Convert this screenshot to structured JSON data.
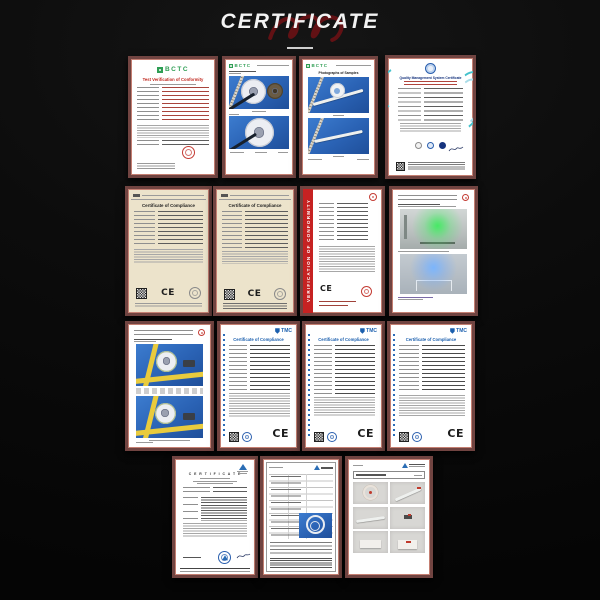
{
  "page": {
    "title": "CERTIFICATE",
    "section": "product certificates gallery",
    "background_color": "#0c0c0c"
  },
  "colors": {
    "frame": "#714441",
    "frame_highlight": "#c47f72",
    "title_swirl_red": "#7a1115",
    "bctc_green": "#2f9e54",
    "tmc_blue": "#1b5fae",
    "banner_red": "#c62222",
    "cream_paper": "#ece3cb",
    "photo_blue": "#2a62b4"
  },
  "icons": {
    "swirl": "red-script-swirl",
    "bctc_logo": "green-grid-square",
    "tmc_logo": "blue-shield",
    "tuv_logo": "blue-triangle",
    "qms_logo": "blue-ring-seal",
    "qr": "qr-code",
    "stamp": "round-stamp",
    "ce": "CE-mark"
  },
  "certs": {
    "r1c1": {
      "brand": "BCTC",
      "title": "Test Verification of Conformity"
    },
    "r1c2": {
      "brand": "BCTC"
    },
    "r1c3": {
      "brand": "BCTC",
      "title": "Photographs of Samples"
    },
    "r1c4": {
      "title": "Quality Management System Certificate"
    },
    "r2c1": {
      "title": "Certificate of Compliance",
      "ce": "CE"
    },
    "r2c2": {
      "title": "Certificate of Compliance",
      "ce": "CE"
    },
    "r2c3": {
      "banner": "VERIFICATION OF CONFORMITY",
      "ce": "CE"
    },
    "r3c2": {
      "brand": "TMC",
      "title": "Certificate of Compliance",
      "ce": "CE"
    },
    "r3c3": {
      "brand": "TMC",
      "title": "Certificate of Compliance",
      "ce": "CE"
    },
    "r3c4": {
      "brand": "TMC",
      "title": "Certificate of Compliance",
      "ce": "CE"
    },
    "r4c1": {
      "title": "C E R T I F I C A T E"
    }
  }
}
